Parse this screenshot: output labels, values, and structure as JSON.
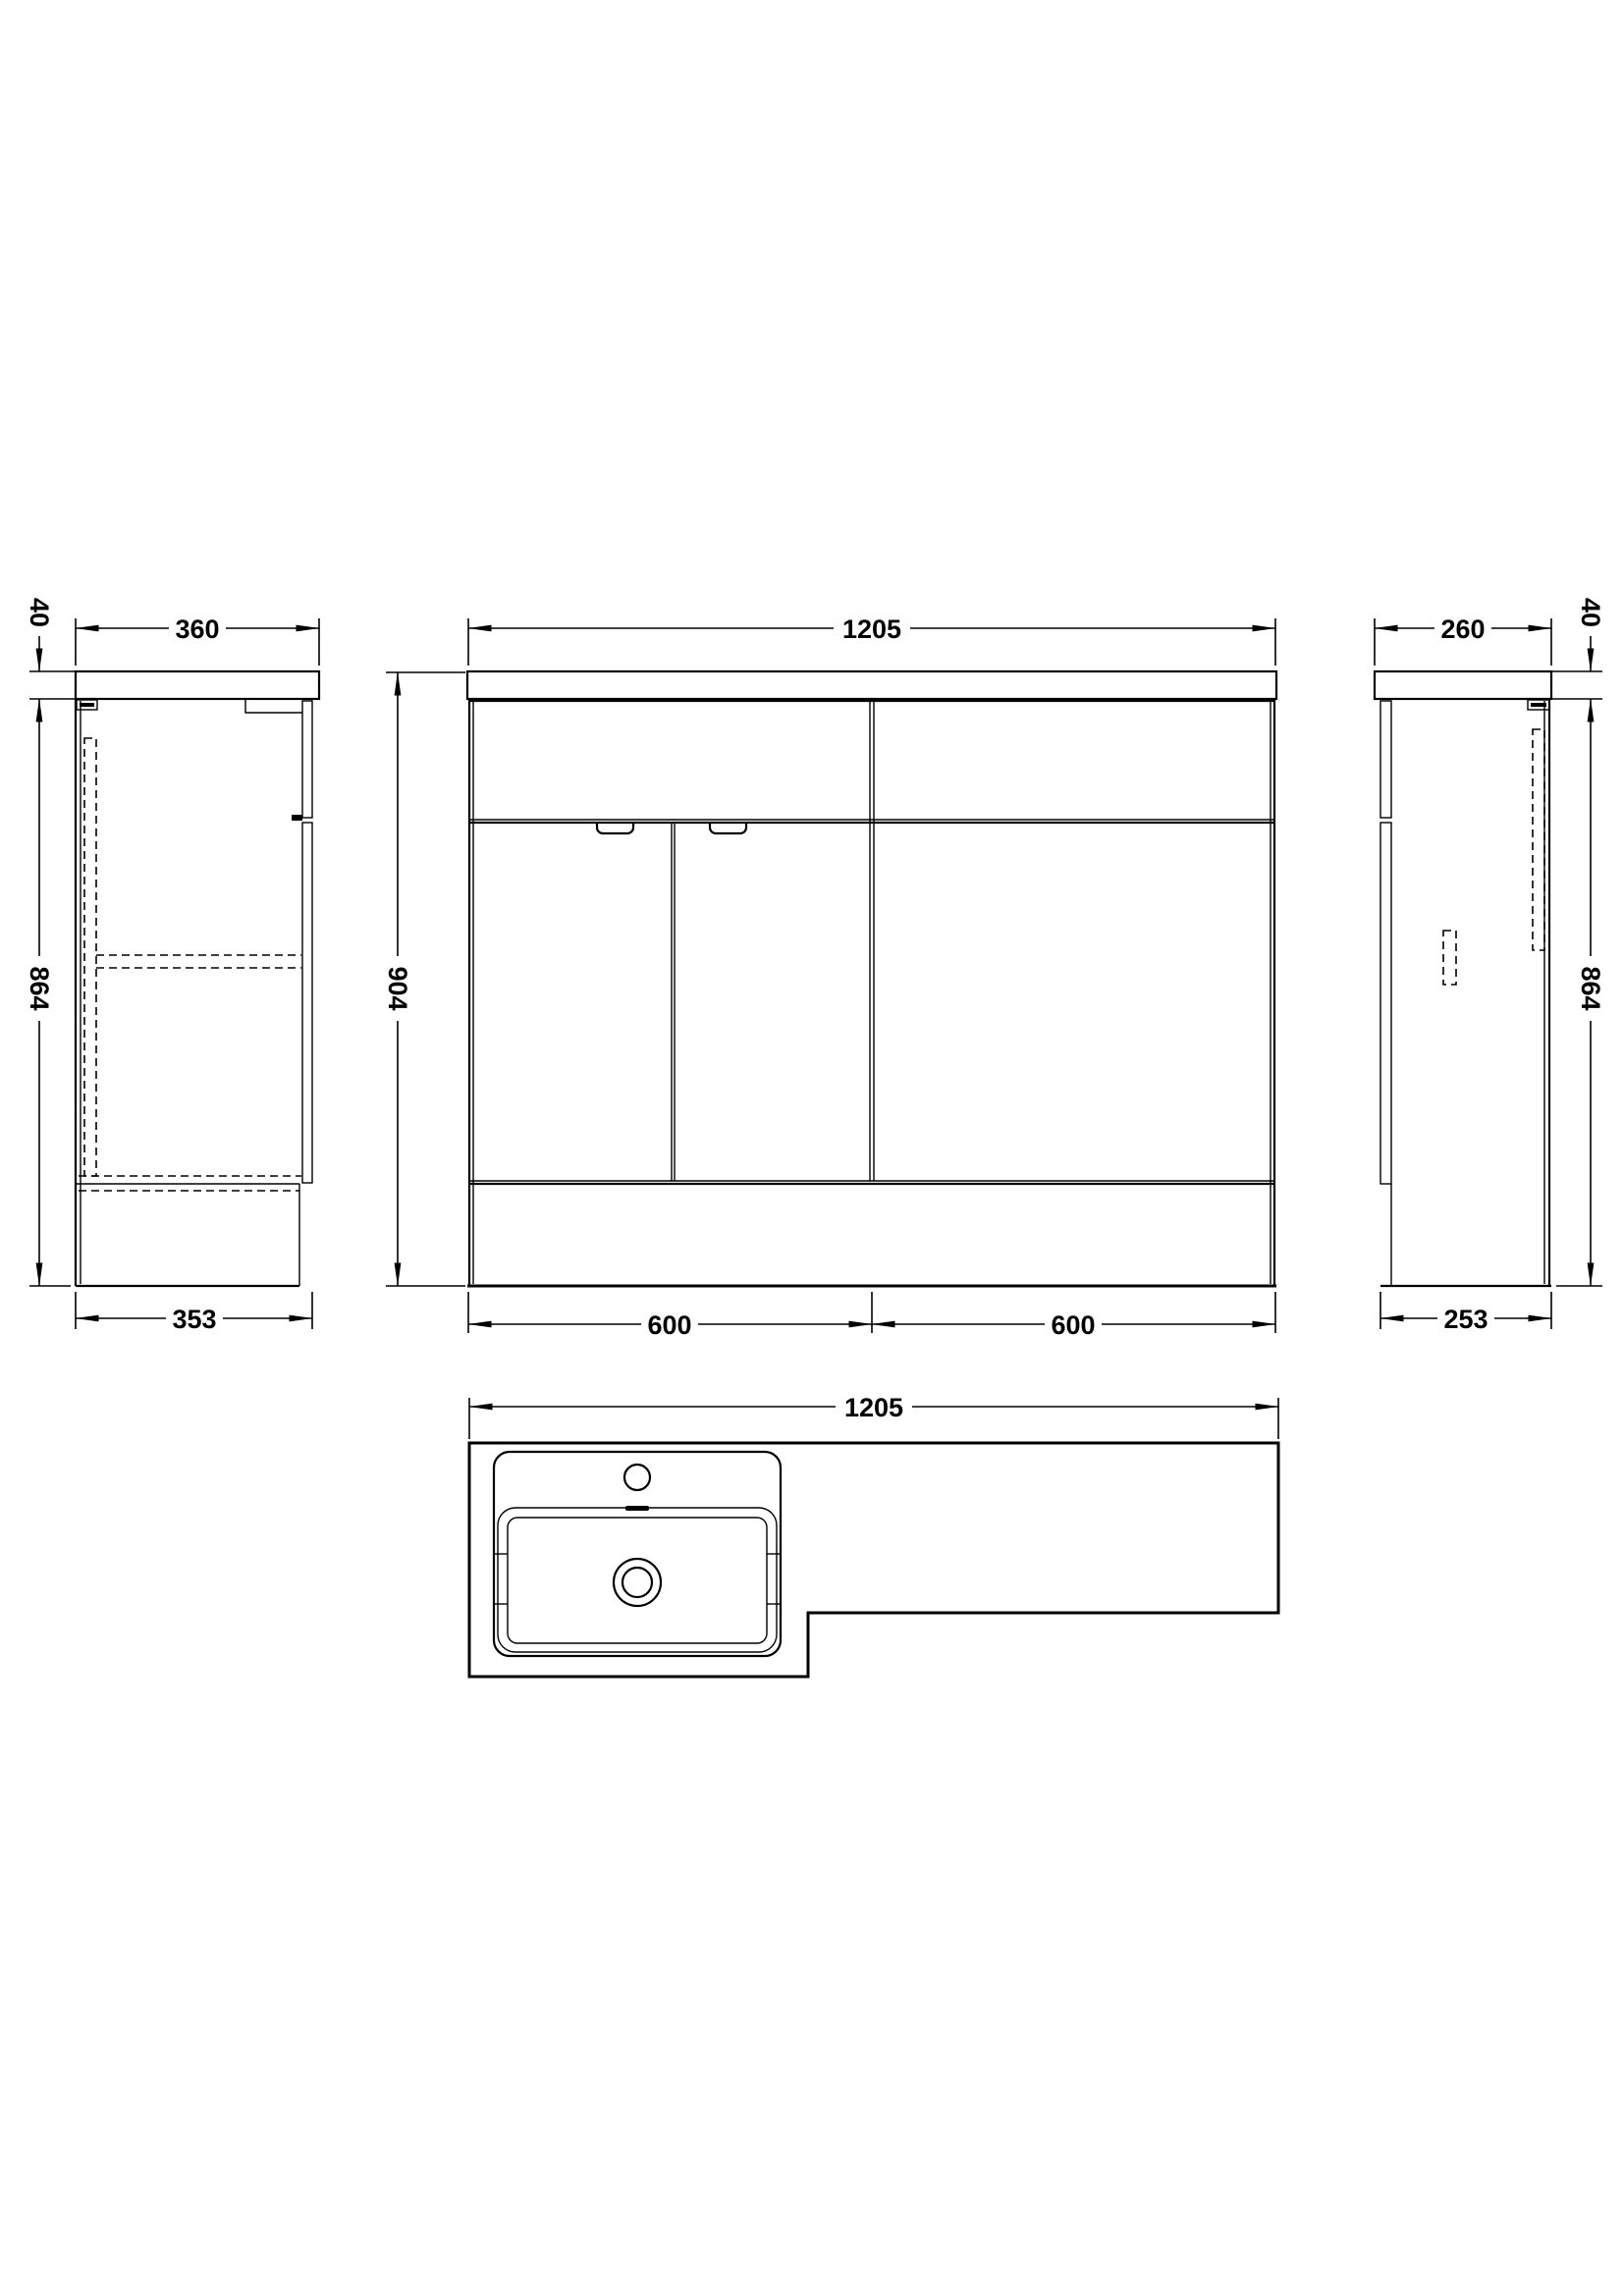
{
  "drawing": {
    "type": "technical-orthographic-drawing",
    "subject": "bathroom vanity and WC combination unit",
    "line_color": "#000000",
    "background_color": "#ffffff",
    "units": "mm"
  },
  "views": {
    "left_side": {
      "label": "left side elevation",
      "dim_thickness": "40",
      "dim_width": "360",
      "dim_height": "864",
      "dim_depth": "353"
    },
    "front": {
      "label": "front elevation",
      "dim_width": "1205",
      "dim_height": "904",
      "dim_left": "600",
      "dim_right": "600"
    },
    "right_side": {
      "label": "right side elevation",
      "dim_width": "260",
      "dim_thickness": "40",
      "dim_height": "864",
      "dim_depth": "253"
    },
    "plan": {
      "label": "plan view with basin",
      "dim_width": "1205"
    }
  }
}
